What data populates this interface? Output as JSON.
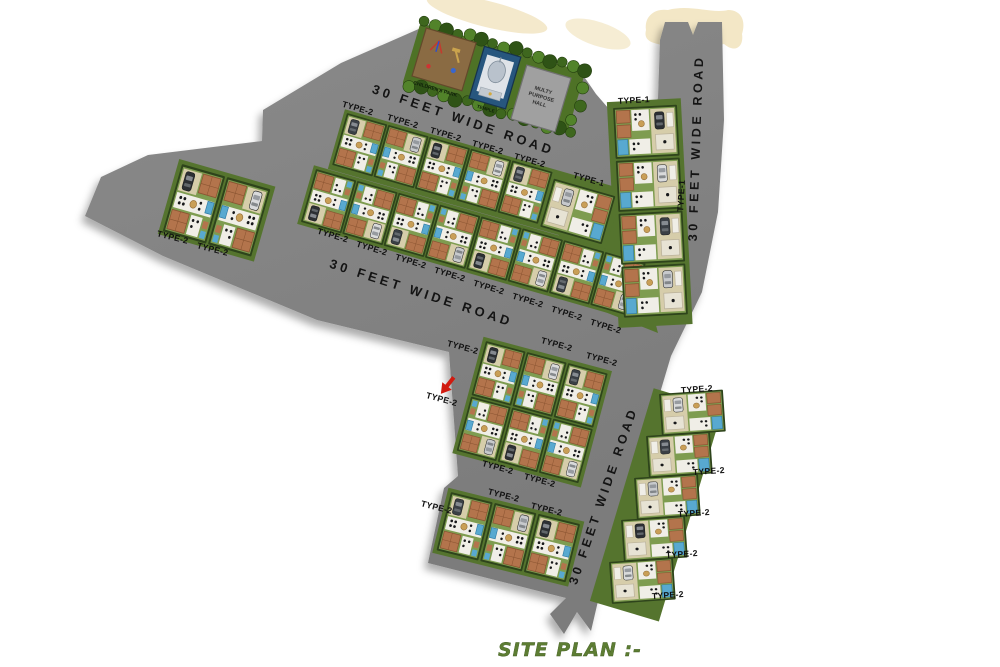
{
  "title": "SITE PLAN :-",
  "roads": [
    {
      "id": "north-road",
      "label": "30 FEET WIDE ROAD"
    },
    {
      "id": "middle-road",
      "label": "30 FEET WIDE ROAD"
    },
    {
      "id": "east-road",
      "label": "30 FEET WIDE ROAD"
    },
    {
      "id": "south-road",
      "label": "30 FEET WIDE ROAD"
    }
  ],
  "amenities": [
    {
      "id": "childrens-park",
      "name": "CHILDREN'S PARK"
    },
    {
      "id": "temple",
      "name": "TEMPLE"
    },
    {
      "id": "multipurpose-hall",
      "name": "MULTY PURPOSE HALL",
      "lines": [
        "MULTY",
        "PURPOSE",
        "HALL"
      ]
    }
  ],
  "plot_types": {
    "type1": "TYPE-1",
    "type2": "TYPE-2"
  },
  "blocks": [
    {
      "id": "west-block",
      "plot_type": "type2",
      "plots": 2
    },
    {
      "id": "middle-row-1",
      "plot_type": "type2",
      "plots": 5,
      "end_plot": "type1"
    },
    {
      "id": "middle-row-2",
      "plot_type": "type2",
      "plots": 8
    },
    {
      "id": "east-column",
      "plot_type": "type1",
      "plots": 3,
      "end_plot": "type2"
    },
    {
      "id": "south-2x3-block",
      "plot_type": "type2",
      "plots": 6
    },
    {
      "id": "south-1x3-block",
      "plot_type": "type2",
      "plots": 3
    },
    {
      "id": "southeast-column",
      "plot_type": "type2",
      "plots": 5
    }
  ],
  "marker": {
    "type": "red-arrow"
  },
  "colors": {
    "road": "#828282",
    "road_dark": "#787878",
    "hedge": "#2e441b",
    "block_green": "#55742e",
    "plot_green": "#7e9c50",
    "terracotta": "#b3744c",
    "beige": "#d6cdaa",
    "pool": "#58a9d0",
    "car_dark": "#2c2f33",
    "car_light": "#d9dadb",
    "label_text": "#101010",
    "road_text": "#141414",
    "title_green": "#5d7d33",
    "cream": "#f3e7c6",
    "park_sand": "#8a6b43",
    "temple_blue": "#27567e",
    "hall_gray": "#a0a0a0"
  }
}
